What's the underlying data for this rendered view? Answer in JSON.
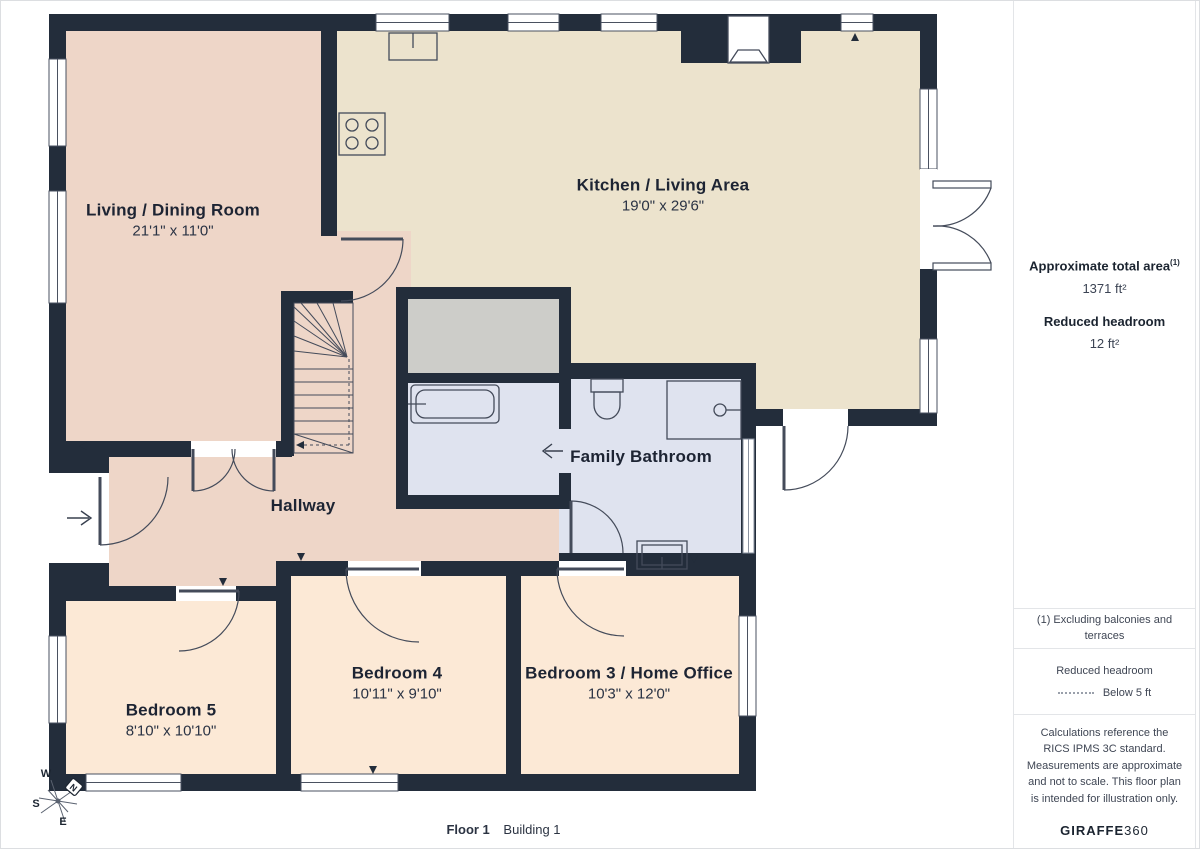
{
  "plan": {
    "rooms": [
      {
        "name": "Living / Dining Room",
        "dims": "21'1\" x 11'0\""
      },
      {
        "name": "Kitchen / Living Area",
        "dims": "19'0\" x 29'6\""
      },
      {
        "name": "Family Bathroom",
        "dims": ""
      },
      {
        "name": "Hallway",
        "dims": ""
      },
      {
        "name": "Bedroom 5",
        "dims": "8'10\" x 10'10\""
      },
      {
        "name": "Bedroom 4",
        "dims": "10'11\" x 9'10\""
      },
      {
        "name": "Bedroom 3 / Home Office",
        "dims": "10'3\" x 12'0\""
      }
    ],
    "compass": {
      "n": "N",
      "e": "E",
      "s": "S",
      "w": "W"
    },
    "colors": {
      "wall": "#232d3b",
      "living_hallway": "#eed6c8",
      "kitchen": "#ece3cd",
      "bedroom": "#fce9d6",
      "bathroom": "#dfe3ef",
      "storage": "#cdcdc9"
    }
  },
  "sidebar": {
    "area_label": "Approximate total area",
    "area_sup": "(1)",
    "area_value": "1371 ft²",
    "headroom_label": "Reduced headroom",
    "headroom_value": "12 ft²",
    "note_exclusions": "(1) Excluding balconies and terraces",
    "legend_label": "Reduced headroom",
    "legend_value": "Below 5 ft",
    "disclaimer": "Calculations reference the RICS IPMS 3C standard. Measurements are approximate and not to scale. This floor plan is intended for illustration only.",
    "brand_name": "GIRAFFE",
    "brand_num": "360"
  },
  "footer": {
    "floor": "Floor 1",
    "building": "Building 1"
  }
}
